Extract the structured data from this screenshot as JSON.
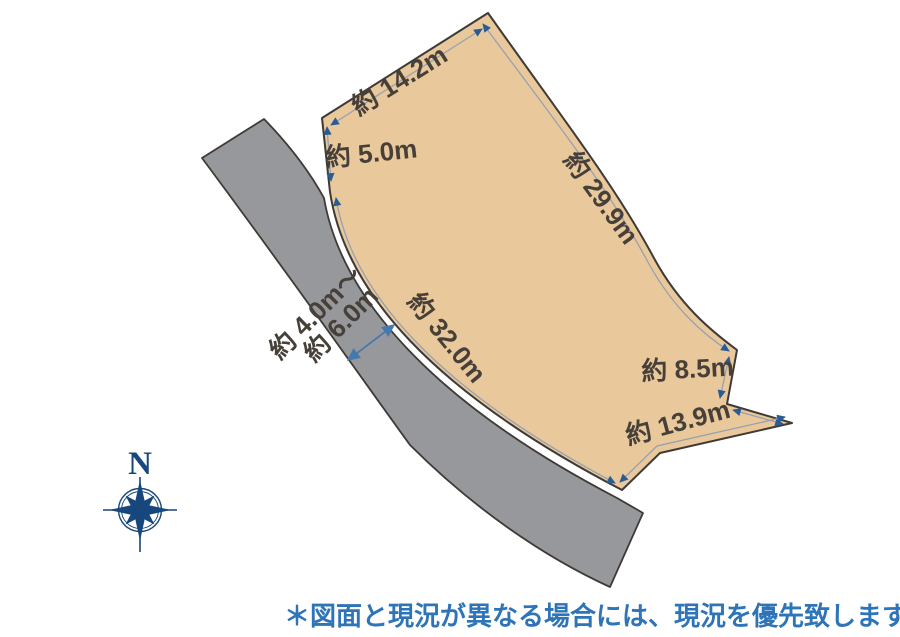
{
  "measurements": {
    "top_edge": "約 14.2m",
    "upper_left_edge": "約 5.0m",
    "right_edge": "約 29.9m",
    "road_side_edge": "約 32.0m",
    "lower_right_edge": "約 8.5m",
    "bottom_edge": "約 13.9m",
    "road_width": {
      "line1": "約 4.0m～",
      "line2": "約 6.0m"
    }
  },
  "compass": {
    "north_label": "N"
  },
  "footnote": {
    "text": "＊図面と現況が異なる場合には、現況を優先致します。"
  },
  "colors": {
    "background": "#ffffff",
    "land_fill": "#e9c89c",
    "road_fill": "#97989c",
    "outline": "#3e3a35",
    "dimension_line": "#98a0b0",
    "arrowhead": "#2a5c94",
    "road_width_arrow": "#4579ad",
    "compass": "#17477c",
    "label_text": "#474039",
    "footnote_text": "#2e74b8"
  }
}
